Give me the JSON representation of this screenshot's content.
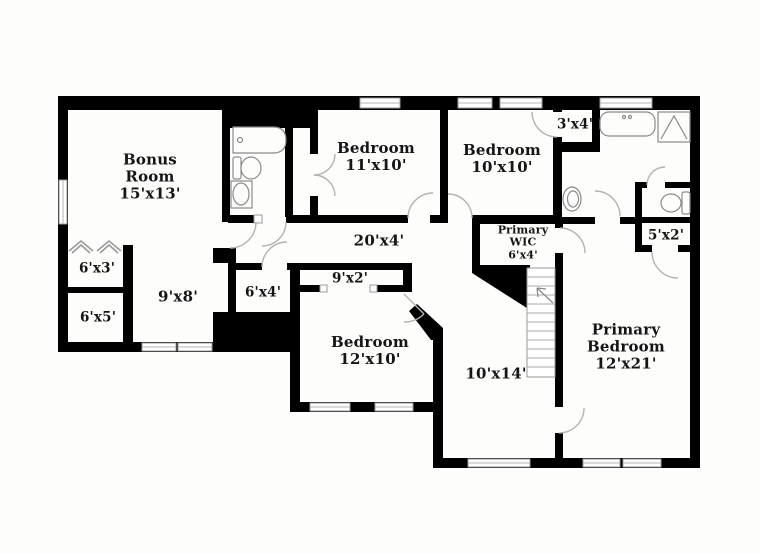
{
  "floor_plan": {
    "type": "residential-floor-plan",
    "colors": {
      "wall": "#000000",
      "background": "#fdfdfc",
      "fixture_stroke": "#8a8a8a",
      "door_arc": "#b3b3b3",
      "window_stroke": "#9a9a9a",
      "label_text": "#151515"
    },
    "rooms": [
      {
        "id": "bonus-room",
        "label": "Bonus\nRoom\n15'x13'"
      },
      {
        "id": "bedroom-11x10",
        "label": "Bedroom\n11'x10'"
      },
      {
        "id": "bedroom-10x10",
        "label": "Bedroom\n10'x10'"
      },
      {
        "id": "closet-3x4",
        "label": "3'x4'"
      },
      {
        "id": "hallway-20x4",
        "label": "20'x4'"
      },
      {
        "id": "primary-wic",
        "label": "Primary\nWIC\n6'x4'"
      },
      {
        "id": "closet-5x2",
        "label": "5'x2'"
      },
      {
        "id": "closet-6x3",
        "label": "6'x3'"
      },
      {
        "id": "closet-6x5",
        "label": "6'x5'"
      },
      {
        "id": "area-9x8",
        "label": "9'x8'"
      },
      {
        "id": "closet-6x4",
        "label": "6'x4'"
      },
      {
        "id": "closet-9x2",
        "label": "9'x2'"
      },
      {
        "id": "bedroom-12x10",
        "label": "Bedroom\n12'x10'"
      },
      {
        "id": "area-10x14",
        "label": "10'x14'"
      },
      {
        "id": "primary-bedroom",
        "label": "Primary\nBedroom\n12'x21'"
      }
    ],
    "icons": [
      "bathtub-icon",
      "toilet-icon",
      "sink-icon",
      "shower-icon",
      "staircase-icon",
      "stair-direction-arrow-icon",
      "attic-chevron-icon",
      "window-icon",
      "door-swing-icon"
    ]
  }
}
